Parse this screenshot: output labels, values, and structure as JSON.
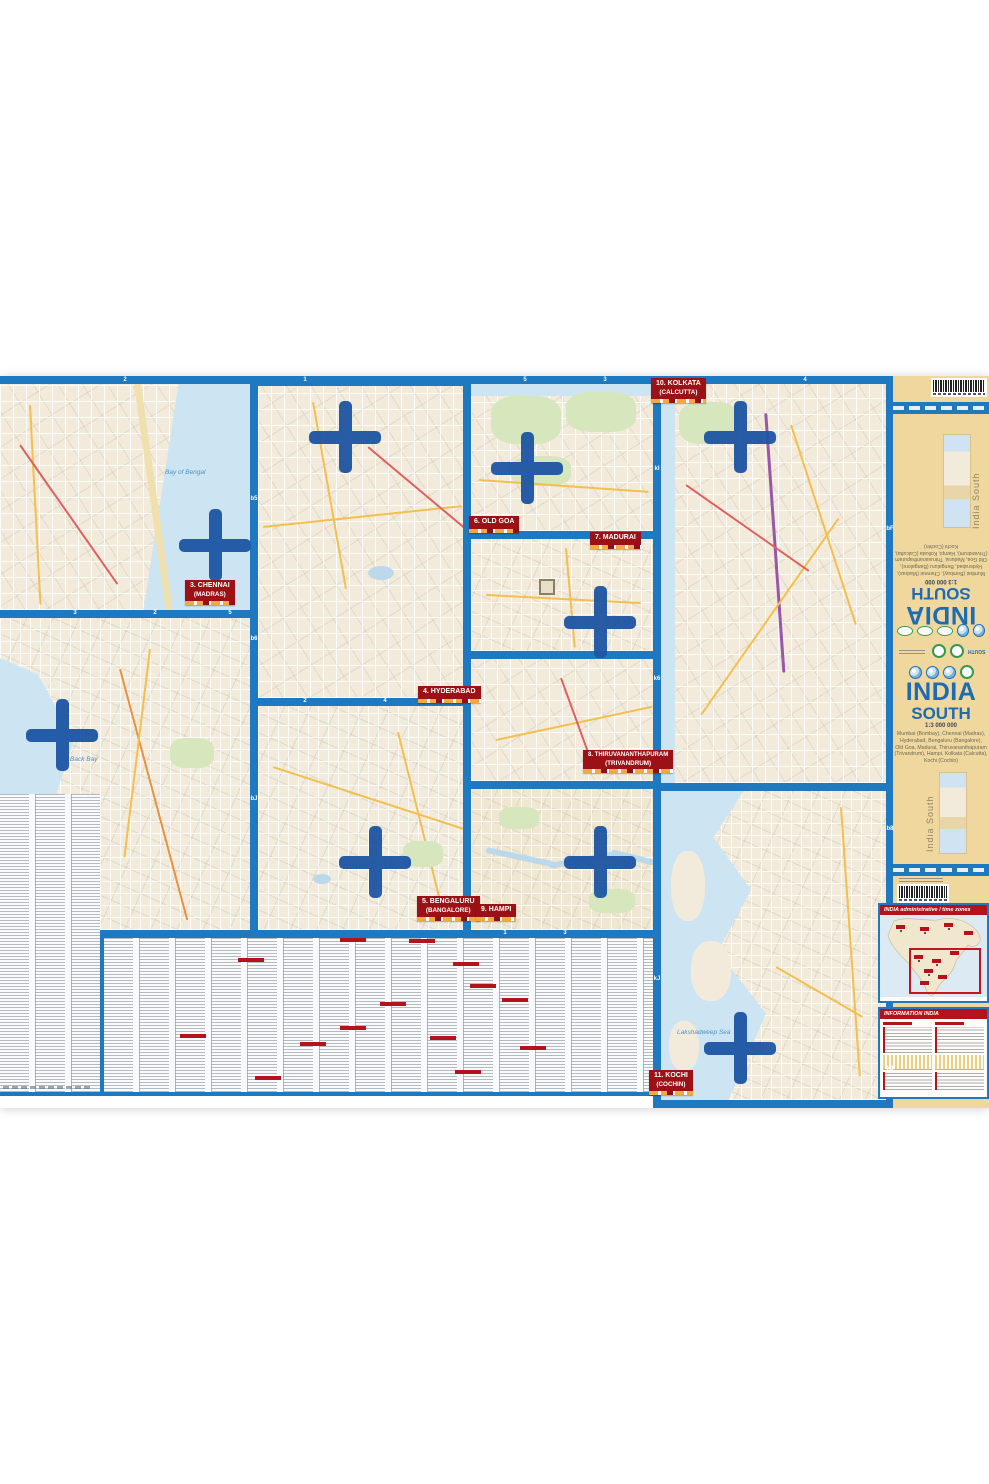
{
  "map_sheet": {
    "border_color": "#1e79c0",
    "cover_color": "#efd79d"
  },
  "panels": {
    "mumbai": {
      "label": "2. MUMBAI",
      "alt": "(BOMBAY)",
      "water": "Back Bay"
    },
    "chennai": {
      "label": "3. CHENNAI",
      "alt": "(MADRAS)",
      "water": "Bay of Bengal"
    },
    "hyderabad": {
      "label": "4. HYDERABAD",
      "alt": ""
    },
    "bengaluru": {
      "label": "5. BENGALURU",
      "alt": "(BANGALORE)"
    },
    "oldgoa": {
      "label": "6. OLD GOA",
      "alt": ""
    },
    "madurai": {
      "label": "7. MADURAI",
      "alt": ""
    },
    "thiruvananthapuram": {
      "label": "8. THIRUVANANTHAPURAM",
      "alt": "(TRIVANDRUM)"
    },
    "hampi": {
      "label": "9. HAMPI",
      "alt": ""
    },
    "kolkata": {
      "label": "10. KOLKATA",
      "alt": "(CALCUTTA)"
    },
    "kochi": {
      "label": "11. KOCHI",
      "alt": "(COCHIN)",
      "water": "Lakshadweep Sea"
    }
  },
  "cover": {
    "title_top": "INDIA",
    "title_bottom": "SOUTH",
    "scale": "1:3 000 000",
    "cities_line1": "Mumbai (Bombay), Chennai (Madras),",
    "cities_line2": "Hyderabad, Bengaluru (Bangalore),",
    "cities_line3": "Old Goa, Madurai, Thiruvananthapuram",
    "cities_line4": "(Trivandrum), Hampi, Kolkata (Calcutta),",
    "cities_line5": "Kochi (Cochin)",
    "spine_text": "India South",
    "badge_south": "SOUTH"
  },
  "side_panels": {
    "admin_header": "INDIA administrative / time zones",
    "info_header": "INFORMATION INDIA"
  },
  "grid_refs": [
    "2",
    "1",
    "5",
    "3",
    "4",
    "3",
    "2",
    "5",
    "2",
    "4",
    "1",
    "3",
    "b5",
    "b6",
    "bJ",
    "kI",
    "k6",
    "kJ",
    "bF",
    "b8",
    "k8"
  ]
}
